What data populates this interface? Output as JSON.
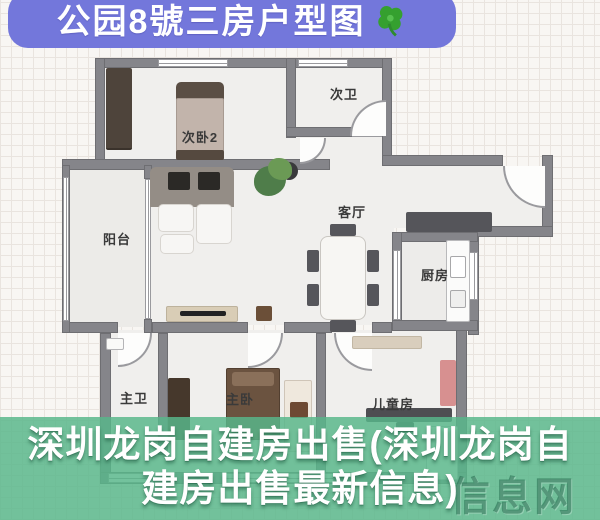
{
  "banner": {
    "title": "公园8號三房户型图",
    "icon": "clover-icon",
    "bg_color": "#7377db",
    "text_color": "#ffffff"
  },
  "floorplan": {
    "wall_color": "#85858a",
    "floor_color": "#f0efed",
    "rooms": [
      {
        "id": "bedroom2",
        "label": "次卧2"
      },
      {
        "id": "bath2",
        "label": "次卫"
      },
      {
        "id": "living",
        "label": "客厅"
      },
      {
        "id": "balcony",
        "label": "阳台"
      },
      {
        "id": "kitchen",
        "label": "厨房"
      },
      {
        "id": "bath1",
        "label": "主卫"
      },
      {
        "id": "bedroom1",
        "label": "主卧"
      },
      {
        "id": "kids",
        "label": "儿童房"
      }
    ]
  },
  "overlay": {
    "band_color": "#58b68a",
    "line1": "深圳龙岗自建房出售(深圳龙岗自",
    "line2": "建房出售最新信息)",
    "text_color": "#ffffff",
    "watermark": "信息网"
  }
}
